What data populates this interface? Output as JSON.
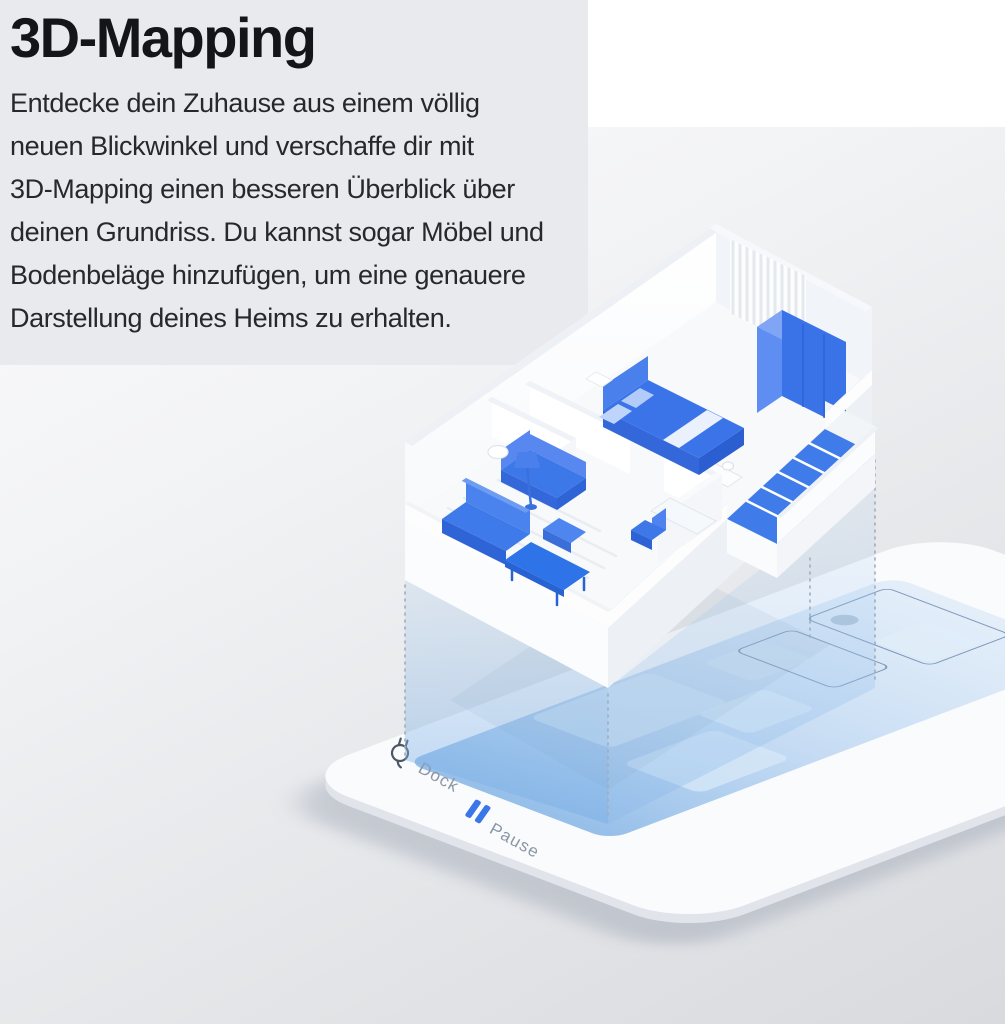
{
  "panel": {
    "title": "3D-Mapping",
    "description": "Entdecke dein Zuhause aus einem völlig\nneuen Blickwinkel und verschaffe dir mit\n3D-Mapping einen besseren Überblick über\ndeinen Grundriss. Du kannst sogar Möbel und\nBodenbeläge hinzufügen, um eine genauere\nDarstellung deines Heims zu erhalten."
  },
  "illustration": {
    "dock_label": "Dock",
    "pause_label": "Pause",
    "icons": {
      "dock": "plug-icon",
      "pause": "pause-icon"
    },
    "colors": {
      "furniture_blue": "#3B74E8",
      "bright_blue": "#2E73E8",
      "projection_blue": "#8FBCEA",
      "map_blue": "#6FA6DE",
      "map_outline": "#7D99B8",
      "label_gray": "#8C96A6",
      "pause_bar_blue": "#3B76E8",
      "platform_white": "#FAFBFD",
      "panel_gray": "#E9EAED"
    }
  }
}
